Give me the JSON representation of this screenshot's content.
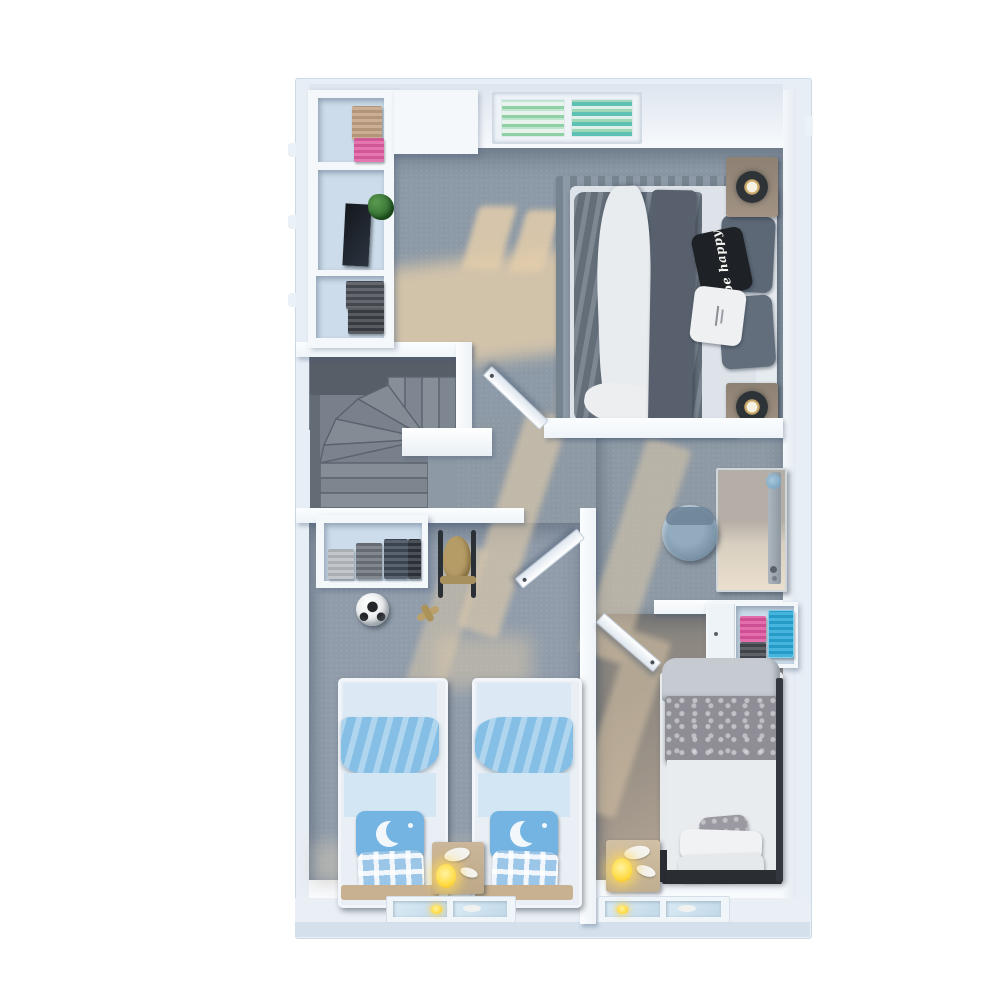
{
  "scene": {
    "type": "3d-floorplan-render",
    "floor": "upper floor",
    "view": "top-down dollhouse render",
    "background": "#ffffff"
  },
  "palette": {
    "outer_wall": "#e8eef5",
    "inner_wall": "#f6f9fc",
    "carpet_gray": "#8c99a6",
    "carpet_warm": "#a89d8f",
    "sunlight": "#e3cdab",
    "duvet_gray": "#6e7a87",
    "kids_blue": "#85bfe6",
    "pink": "#e0569f",
    "teal": "#29a8d8",
    "wood": "#c7b192",
    "lamp_glow": "#ffd93e",
    "pillow_black": "#1e2125",
    "blinds_green": "#7ec9a0"
  },
  "rooms": {
    "master_bedroom": {
      "name": "master bedroom",
      "pillow_text": "be happy",
      "furniture": [
        "double bed",
        "striped rug",
        "nightstand with lamp",
        "nightstand with lamp",
        "wardrobe shelves with clothes",
        "plant",
        "window with green blinds"
      ]
    },
    "stairwell": {
      "name": "stairwell",
      "furniture": [
        "winder staircase"
      ]
    },
    "hallway_study": {
      "name": "hallway / study nook",
      "furniture": [
        "desk",
        "office chair"
      ]
    },
    "kids_bedroom": {
      "name": "kids bedroom",
      "furniture": [
        "twin bed with moon pillow",
        "twin bed with moon pillow",
        "nightstand with lamp",
        "wardrobe with folded clothes",
        "rocking horse",
        "soccer ball",
        "toy plane",
        "window"
      ]
    },
    "bedroom_2": {
      "name": "bedroom 2",
      "furniture": [
        "single bed",
        "nightstand with lamp",
        "shelf with folded clothes",
        "window"
      ]
    }
  }
}
